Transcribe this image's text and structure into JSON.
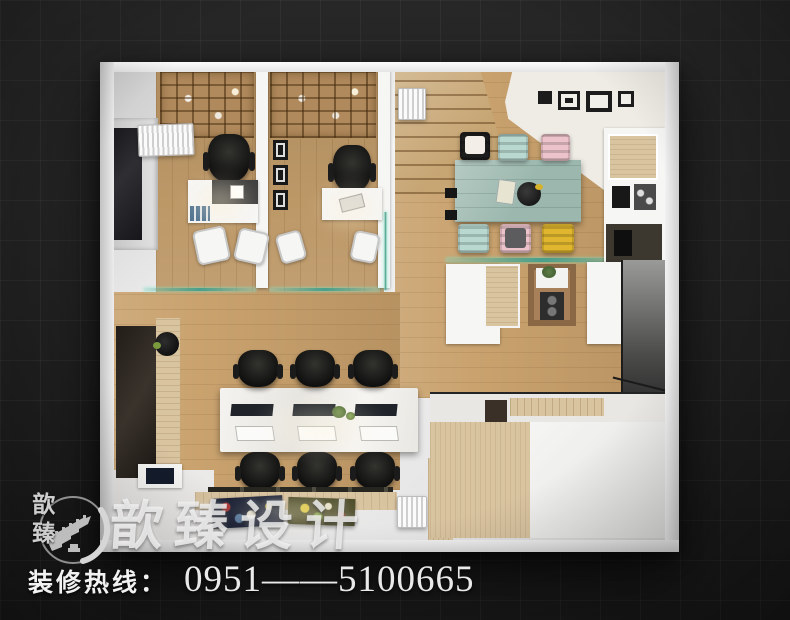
{
  "watermark": {
    "logo_chars": "歆臻",
    "brand": "歆臻设计",
    "hotline_label": "装修热线：",
    "hotline_number": "0951——5100665"
  },
  "palette": {
    "background": "#232323",
    "wall": "#ececec",
    "wood_floor": "#c9a26e",
    "meeting_table_teal": "#9cb8ae",
    "chair_mint": "#b9d8d0",
    "chair_pink": "#ecc3ca",
    "chair_yellow": "#e0b62e",
    "glass_partition": "#49a08b",
    "watermark_text": "#f0f0f0"
  },
  "scene": {
    "type": "top-down 3D interior render of an office floor plan on dark tiled background",
    "areas": [
      "private-office-1",
      "private-office-2",
      "staircase",
      "meeting-area",
      "kitchenette",
      "open-office-workstations",
      "media-wall-window",
      "reception-platform",
      "display-ledge",
      "entry-corridor"
    ],
    "meeting_chairs": [
      "black-white-cushion",
      "mint",
      "pink",
      "mint",
      "pink-gray-cushion",
      "yellow"
    ],
    "workstation_count": 6
  }
}
